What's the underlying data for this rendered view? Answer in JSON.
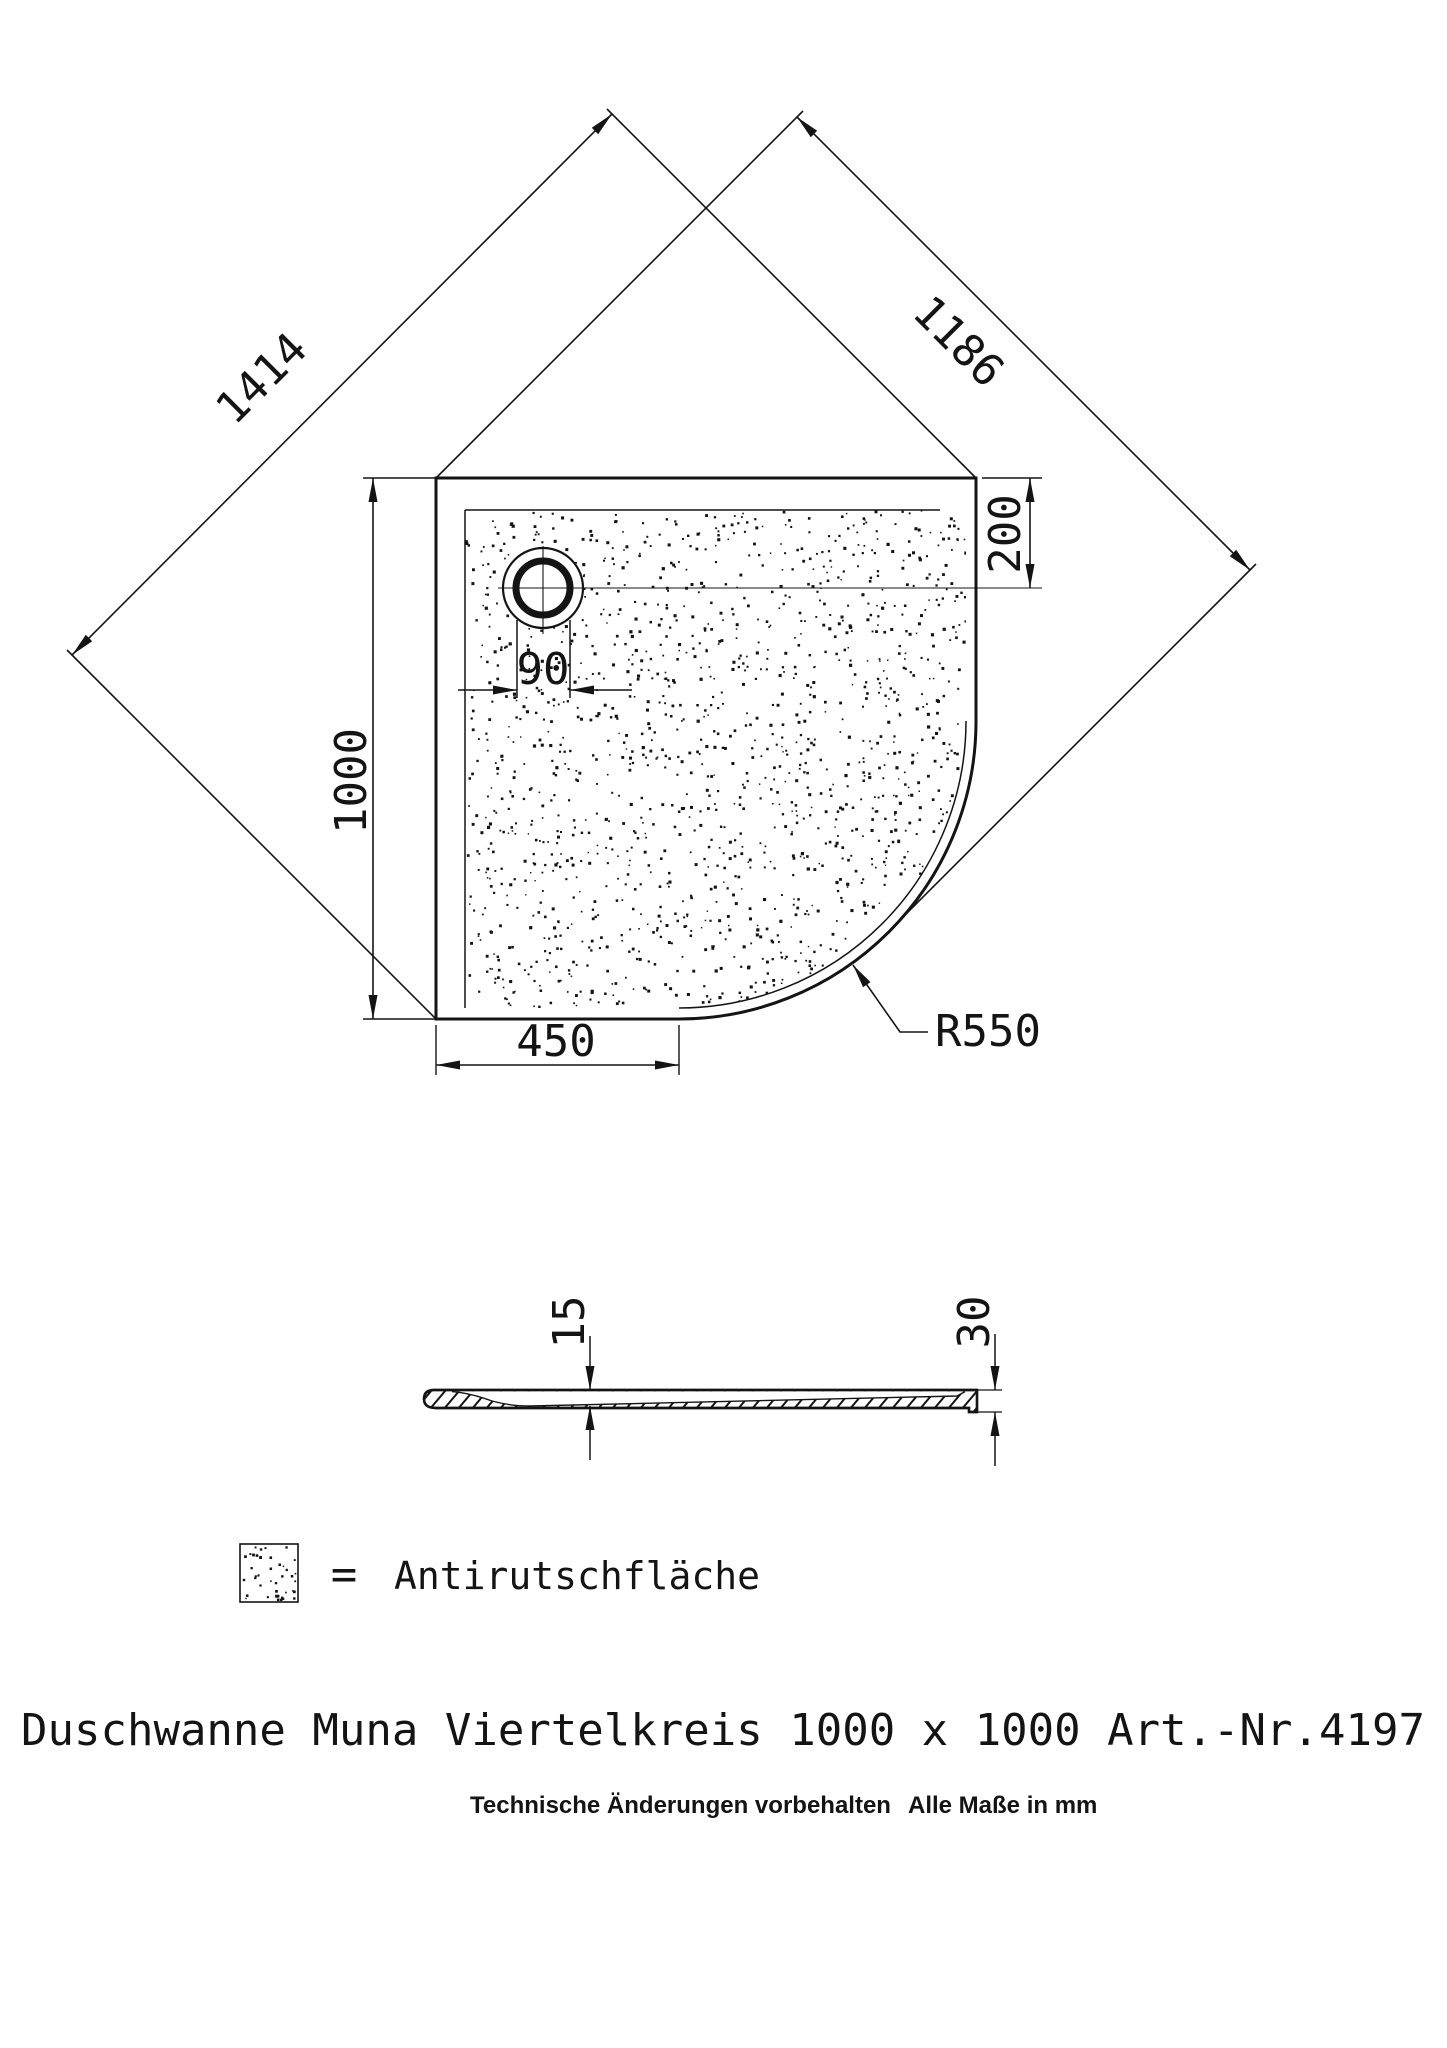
{
  "colors": {
    "background": "#ffffff",
    "ink": "#141414"
  },
  "plan_view": {
    "dim_diagonal": "1414",
    "dim_diagonal_to_arc": "1186",
    "dim_side": "1000",
    "dim_bottom_edge": "450",
    "dim_drain_diameter": "90",
    "dim_drain_offset_top": "200",
    "radius_label": "R550"
  },
  "section_view": {
    "dim_basin_depth": "15",
    "dim_total_height": "30"
  },
  "legend": {
    "equals_sign": "=",
    "label": "Antirutschfläche"
  },
  "title": "Duschwanne Muna Viertelkreis 1000 x 1000 Art.-Nr.4197",
  "footnote": {
    "left": "Technische Änderungen vorbehalten",
    "right": "Alle Maße in mm"
  }
}
